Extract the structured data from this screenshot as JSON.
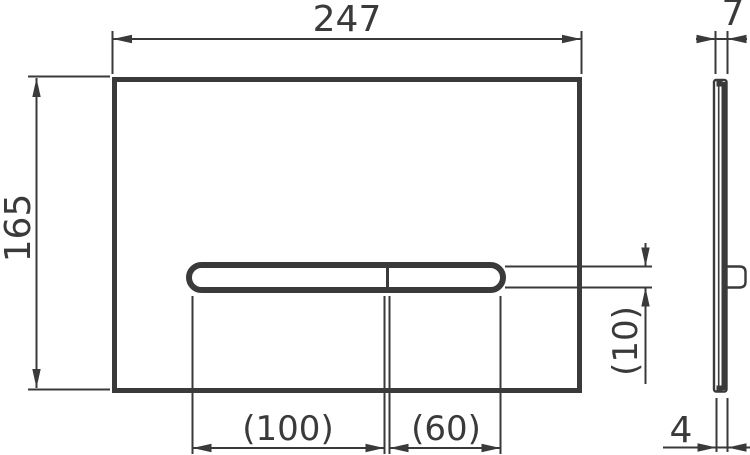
{
  "meta": {
    "type": "technical-drawing",
    "subject": "flush-plate front and side view with dimensions"
  },
  "style": {
    "line_color": "#3a3a3a",
    "background": "#ffffff"
  },
  "dims": {
    "front_width": "247",
    "front_height": "165",
    "side_thickness": "7",
    "button_left_width": "(100)",
    "button_right_width": "(60)",
    "button_height": "(10)",
    "side_base_thickness": "4"
  }
}
